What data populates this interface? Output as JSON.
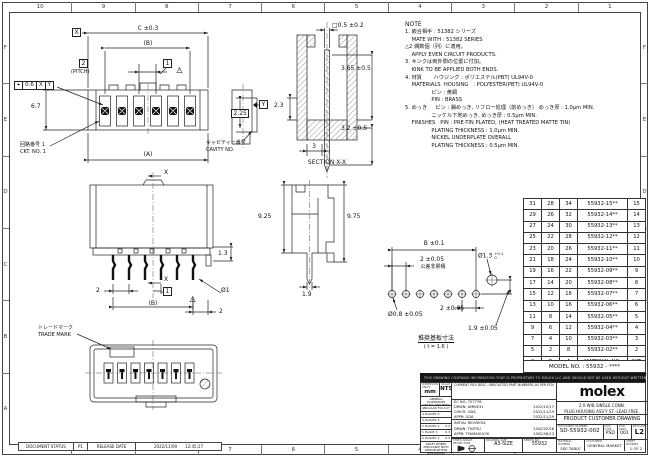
{
  "icons": {
    "triangle": "△",
    "position": "⌖"
  },
  "sheet": {
    "border_columns": [
      "10",
      "9",
      "8",
      "7",
      "6",
      "5",
      "4",
      "3",
      "2",
      "1"
    ],
    "border_rows": [
      "F",
      "E",
      "D",
      "C",
      "B",
      "A"
    ],
    "document_status": {
      "label": "DOCUMENT STATUS",
      "status": "P1",
      "release_label": "RELEASE DATE",
      "date": "2022/11/09",
      "time": "12:45:27"
    }
  },
  "notes": {
    "title": "NOTE",
    "lines": [
      "1. 嵌合相手 : 51382 シリーズ",
      "    MATE WITH : 51382 SERIES",
      "△2 偶数個（列）に適用。",
      "    APPLY EVEN CIRCUIT PRODUCTS.",
      "3. キンクは両外側の位置に付加。",
      "    KINK TO BE APPLIED BOTH ENDS.",
      "4. 材質       ハウジング : ポリエステル(PBT) UL94V-0",
      "    MATERIALS  HOUSING   : POLYESTER(PBT) UL94V-0",
      "                ピン : 黄銅",
      "                PIN : BRASS",
      "5. めっき     ピン : 錫めっき, リフロー処理（前めっき） めっき厚 : 1.0μm MIN.",
      "                ニッケル下地めっき, めっき厚 : 0.5μm MIN.",
      "    FINISHES   PIN : PRE-TIN PLATED, (HEAT TREATED MATTE TIN)",
      "                PLATING THICKNESS : 1.0μm MIN.",
      "                NICKEL UNDERPLATE OVERALL",
      "                PLATING THICKNESS : 0.5μm MIN."
    ]
  },
  "front_view": {
    "datum_x": "X",
    "dim_c": "C ±0.3",
    "dim_b": "(B)",
    "pitch_value": "2",
    "pitch_label": "(PITCH)",
    "end_pitch_value": "1",
    "rev_triangle": "2",
    "position_tol": {
      "value": "0.6",
      "datum1": "X",
      "datum2": "Y"
    },
    "dim_height": "6.7",
    "ckt_label_jp": "回路番号 1",
    "ckt_label_en": "CKT. NO. 1",
    "dim_a": "(A)"
  },
  "cavity_view": {
    "dim_225": "2.25",
    "datum_y": "Y",
    "label_jp": "キャビティー番号",
    "label_en": "CAVITY NO."
  },
  "section_view": {
    "dim_square": "□0.5 ±0.2",
    "dim_365": "3.65 ±0.5",
    "dim_23": "2.3",
    "dim_32": "3.2 ±0.5",
    "dim_3": "3",
    "label": "SECTION X-X"
  },
  "rear_view": {
    "section_x_top": "X",
    "section_x_bottom": "X",
    "dim_pitch": "2",
    "end_pitch_value": "1",
    "rev_triangle": "2",
    "dim_b": "(B)",
    "dim_13": "1.3",
    "dim_d1": "Ø1",
    "dim_2": "2"
  },
  "side_view": {
    "dim_925": "9.25",
    "dim_975": "9.75",
    "dim_19": "1.9"
  },
  "pcb_layout": {
    "dim_b": "B ±0.1",
    "dim_pitch": "2 ±0.05",
    "note_jp": "公差非累積",
    "dim_d13": "Ø1.3",
    "dim_d13_upper": "+0.1",
    "dim_d13_lower": "0",
    "dim_d08": "Ø0.8 ±0.05",
    "dim_2": "2 ±0.05",
    "dim_19": "1.9 ±0.05",
    "title_jp": "推奨基板寸法",
    "scale_note": "( t = 1.6 )"
  },
  "bottom_view": {
    "trademark_jp": "トレードマーク",
    "trademark_en": "TRADE MARK"
  },
  "table": {
    "headers": [
      "C",
      "B",
      "A",
      "MATERIAL NO.",
      "CKT."
    ],
    "rows": [
      [
        "31",
        "28",
        "34",
        "55932-15**",
        "15"
      ],
      [
        "29",
        "26",
        "32",
        "55932-14**",
        "14"
      ],
      [
        "27",
        "24",
        "30",
        "55932-13**",
        "13"
      ],
      [
        "25",
        "22",
        "28",
        "55932-12**",
        "12"
      ],
      [
        "23",
        "20",
        "26",
        "55932-11**",
        "11"
      ],
      [
        "21",
        "18",
        "24",
        "55932-10**",
        "10"
      ],
      [
        "19",
        "16",
        "22",
        "55932-09**",
        "9"
      ],
      [
        "17",
        "14",
        "20",
        "55932-08**",
        "8"
      ],
      [
        "15",
        "12",
        "18",
        "55932-07**",
        "7"
      ],
      [
        "13",
        "10",
        "16",
        "55932-06**",
        "6"
      ],
      [
        "11",
        "8",
        "14",
        "55932-05**",
        "5"
      ],
      [
        "9",
        "6",
        "12",
        "55932-04**",
        "4"
      ],
      [
        "7",
        "4",
        "10",
        "55932-03**",
        "3"
      ],
      [
        "5",
        "2",
        "8",
        "55932-02**",
        "2"
      ]
    ],
    "model_no": "MODEL NO. : 55932 - ****"
  },
  "title_block": {
    "proprietary_notice": "THIS DRAWING CONTAINS INFORMATION THAT IS PROPRIETARY TO MOLEX LLC AND SHOULD NOT BE USED WITHOUT WRITTEN PERMISSION",
    "units_label": "DIMENSION UNITS",
    "units": "mm",
    "scale_label": "SCALE",
    "scale": "NTS",
    "general_tolerances": "GENERAL TOLERANCES (UNLESS SPECIFIED)",
    "tolerances": [
      {
        "label": "ANGULAR TOL ±",
        "value": "3.0°"
      },
      {
        "label": "4 PLACES ±",
        "value": ""
      },
      {
        "label": "3 PLACES ±",
        "value": ""
      },
      {
        "label": "2 PLACES ±",
        "value": "0.3"
      },
      {
        "label": "1 PLACE ±",
        "value": "0.3"
      },
      {
        "label": "0 PLACES ±",
        "value": "0.5"
      }
    ],
    "draft_note": "DRAFT WHERE APPLICABLE MUST REMAIN WITHIN DIMENSIONS",
    "current_rev": "CURRENT REV DESC: OBSOLETED PART NUMBERS AS PER PCN",
    "ec_no_label": "EC NO:",
    "ec_no": "727776",
    "drwn_label": "DRWN:",
    "drwn": "AMIKE31",
    "drwn_date": "2022/10/17",
    "chkd_label": "CHK'D:",
    "chkd": "GDA",
    "chkd_date": "2022/11/29",
    "appr_label": "APPR:",
    "appr": "GDA",
    "appr_date": "2022/11/29",
    "initial_revision": "INITIAL REVISION:",
    "init_drwn_label": "DRWN:",
    "init_drwn": "TNITSU",
    "init_drwn_date": "2002/02/28",
    "init_appr_label": "APPR:",
    "init_appr": "TYAMAGUCHI",
    "init_appr_date": "2002/06/13",
    "third_angle_label": "THIRD ANGLE PROJECTION",
    "size_label": "DRAWING SIZE",
    "size": "A3-SIZE",
    "series_label": "SERIES NO.",
    "series": "55932",
    "logo": "molex",
    "description_line1": "2.0 W/B SINGLE CONN.",
    "description_line2": "PLUG HOUSING ASS'Y ST -LEAD FREE.",
    "drawing_type": "PRODUCT CUSTOMER DRAWING",
    "doc_number_label": "DOCUMENT NUMBER",
    "doc_number": "SD-55932-002",
    "doc_type_label": "DOC TYPE",
    "doc_type": "PSD",
    "doc_part_label": "DOC PART",
    "doc_part": "001",
    "revision_label": "REVISION",
    "revision": "L2",
    "material_label": "MATERIAL NUMBER",
    "material": "SEE TABLE",
    "customer_label": "CUSTOMER",
    "customer": "GENERAL MARKET",
    "sheet_label": "SHEET NUMBER",
    "sheet": "1 OF 2"
  }
}
